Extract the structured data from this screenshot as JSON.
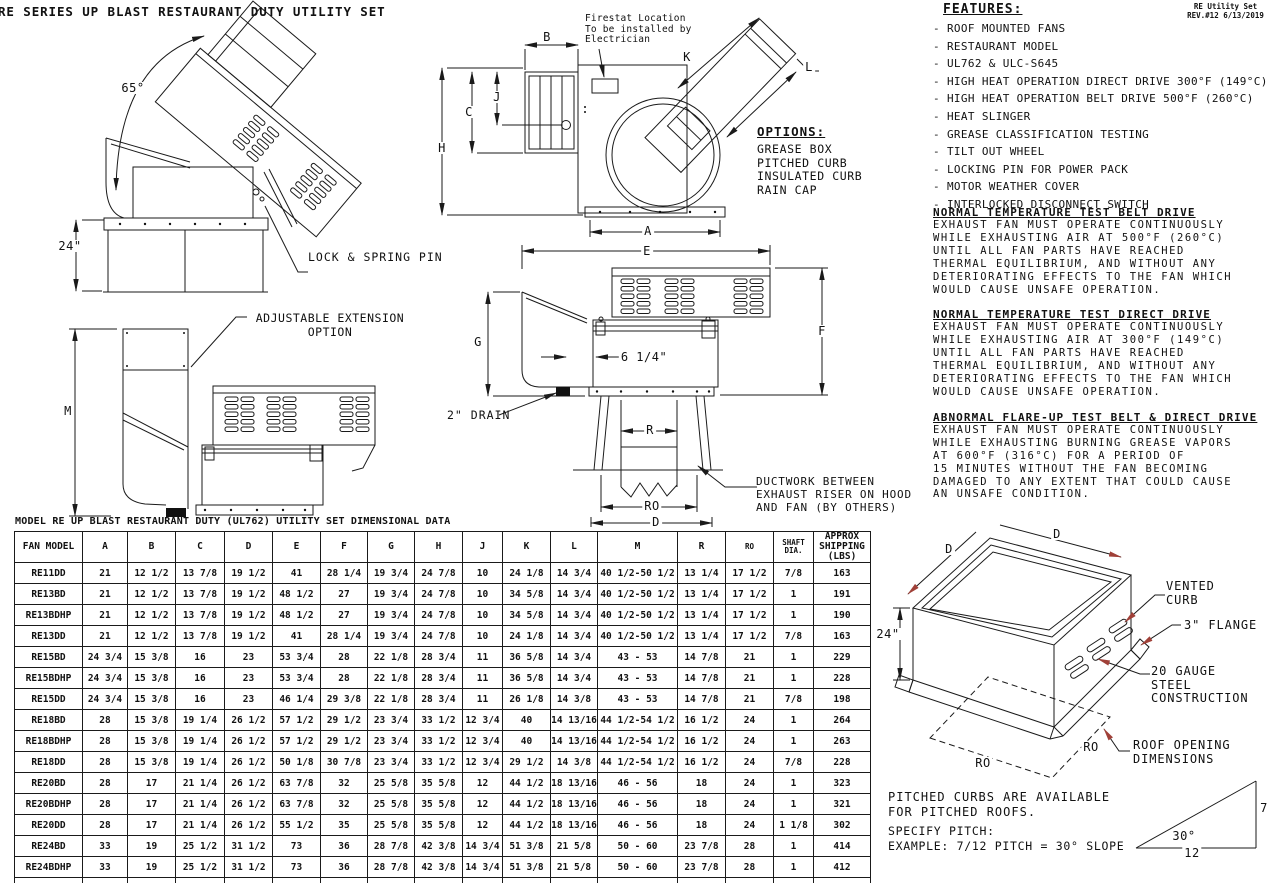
{
  "title": "RE SERIES UP BLAST RESTAURANT DUTY UTILITY SET",
  "rev_note": "RE Utility Set\nREV.#12 6/13/2019",
  "features": {
    "heading": "FEATURES:",
    "items": [
      "ROOF MOUNTED FANS",
      "RESTAURANT MODEL",
      "UL762 & ULC-S645",
      "HIGH HEAT OPERATION DIRECT DRIVE 300°F (149°C)",
      "HIGH HEAT OPERATION BELT DRIVE 500°F (260°C)",
      "HEAT SLINGER",
      "GREASE CLASSIFICATION TESTING",
      "TILT OUT WHEEL",
      "LOCKING PIN FOR POWER PACK",
      "MOTOR WEATHER COVER",
      "INTERLOCKED DISCONNECT SWITCH"
    ]
  },
  "options": {
    "heading": "OPTIONS:",
    "items": [
      "GREASE BOX",
      "PITCHED CURB",
      "INSULATED CURB",
      "RAIN CAP"
    ]
  },
  "tests": [
    {
      "heading": "NORMAL TEMPERATURE TEST BELT DRIVE",
      "body": "EXHAUST FAN MUST OPERATE CONTINUOUSLY\nWHILE EXHAUSTING AIR AT 500°F (260°C)\nUNTIL ALL FAN PARTS HAVE REACHED\nTHERMAL EQUILIBRIUM, AND WITHOUT ANY\nDETERIORATING EFFECTS TO THE FAN WHICH\nWOULD CAUSE UNSAFE OPERATION."
    },
    {
      "heading": "NORMAL TEMPERATURE TEST DIRECT DRIVE",
      "body": "EXHAUST FAN MUST OPERATE CONTINUOUSLY\nWHILE EXHAUSTING AIR AT 300°F (149°C)\nUNTIL ALL FAN PARTS HAVE REACHED\nTHERMAL EQUILIBRIUM, AND WITHOUT ANY\nDETERIORATING EFFECTS TO THE FAN WHICH\nWOULD CAUSE UNSAFE OPERATION."
    },
    {
      "heading": "ABNORMAL FLARE-UP TEST BELT & DIRECT DRIVE",
      "body": "EXHAUST FAN MUST OPERATE CONTINUOUSLY\nWHILE EXHAUSTING BURNING GREASE VAPORS\nAT 600°F (316°C) FOR A PERIOD OF\n15 MINUTES WITHOUT THE FAN BECOMING\nDAMAGED TO ANY EXTENT THAT COULD CAUSE\nAN UNSAFE CONDITION."
    }
  ],
  "notes": {
    "firestat": "Firestat Location\nTo be installed by\nElectrician",
    "lock_pin": "LOCK & SPRING PIN",
    "adjustable": "ADJUSTABLE EXTENSION\nOPTION",
    "ductwork": "DUCTWORK BETWEEN\nEXHAUST RISER ON HOOD\nAND FAN (BY OTHERS)",
    "drain": "2\" DRAIN",
    "riser_offset": "6 1/4\""
  },
  "dim_labels": {
    "a": "A",
    "b": "B",
    "c": "C",
    "d": "D",
    "e": "E",
    "f": "F",
    "g": "G",
    "h": "H",
    "j": "J",
    "k": "K",
    "l": "L",
    "m": "M",
    "r": "R",
    "ro": "RO",
    "angle": "65°",
    "h24": "24\""
  },
  "curb": {
    "d1": "D",
    "d2": "D",
    "height": "24\"",
    "ro1": "RO",
    "ro2": "RO",
    "vented": "VENTED\nCURB",
    "flange": "3\" FLANGE",
    "gauge": "20 GAUGE\nSTEEL\nCONSTRUCTION",
    "roof": "ROOF OPENING\nDIMENSIONS"
  },
  "pitch": {
    "note1": "PITCHED CURBS ARE AVAILABLE\nFOR PITCHED ROOFS.",
    "note2": "SPECIFY PITCH:\nEXAMPLE: 7/12 PITCH = 30° SLOPE",
    "angle": "30°",
    "rise": "7",
    "run": "12"
  },
  "table": {
    "title": "MODEL RE UP BLAST RESTAURANT DUTY (UL762) UTILITY SET DIMENSIONAL DATA",
    "headers": [
      "FAN MODEL",
      "A",
      "B",
      "C",
      "D",
      "E",
      "F",
      "G",
      "H",
      "J",
      "K",
      "L",
      "M",
      "R",
      "RO",
      "SHAFT\nDIA.",
      "APPROX\nSHIPPING\n(LBS)"
    ],
    "rows": [
      [
        "RE11DD",
        "21",
        "12 1/2",
        "13 7/8",
        "19 1/2",
        "41",
        "28 1/4",
        "19 3/4",
        "24 7/8",
        "10",
        "24 1/8",
        "14 3/4",
        "40 1/2-50 1/2",
        "13 1/4",
        "17 1/2",
        "7/8",
        "163"
      ],
      [
        "RE13BD",
        "21",
        "12 1/2",
        "13 7/8",
        "19 1/2",
        "48 1/2",
        "27",
        "19 3/4",
        "24 7/8",
        "10",
        "34 5/8",
        "14 3/4",
        "40 1/2-50 1/2",
        "13 1/4",
        "17 1/2",
        "1",
        "191"
      ],
      [
        "RE13BDHP",
        "21",
        "12 1/2",
        "13 7/8",
        "19 1/2",
        "48 1/2",
        "27",
        "19 3/4",
        "24 7/8",
        "10",
        "34 5/8",
        "14 3/4",
        "40 1/2-50 1/2",
        "13 1/4",
        "17 1/2",
        "1",
        "190"
      ],
      [
        "RE13DD",
        "21",
        "12 1/2",
        "13 7/8",
        "19 1/2",
        "41",
        "28 1/4",
        "19 3/4",
        "24 7/8",
        "10",
        "24 1/8",
        "14 3/4",
        "40 1/2-50 1/2",
        "13 1/4",
        "17 1/2",
        "7/8",
        "163"
      ],
      [
        "RE15BD",
        "24 3/4",
        "15 3/8",
        "16",
        "23",
        "53 3/4",
        "28",
        "22 1/8",
        "28 3/4",
        "11",
        "36 5/8",
        "14 3/4",
        "43 - 53",
        "14 7/8",
        "21",
        "1",
        "229"
      ],
      [
        "RE15BDHP",
        "24 3/4",
        "15 3/8",
        "16",
        "23",
        "53 3/4",
        "28",
        "22 1/8",
        "28 3/4",
        "11",
        "36 5/8",
        "14 3/4",
        "43 - 53",
        "14 7/8",
        "21",
        "1",
        "228"
      ],
      [
        "RE15DD",
        "24 3/4",
        "15 3/8",
        "16",
        "23",
        "46 1/4",
        "29 3/8",
        "22 1/8",
        "28 3/4",
        "11",
        "26 1/8",
        "14 3/8",
        "43 - 53",
        "14 7/8",
        "21",
        "7/8",
        "198"
      ],
      [
        "RE18BD",
        "28",
        "15 3/8",
        "19 1/4",
        "26 1/2",
        "57 1/2",
        "29 1/2",
        "23 3/4",
        "33 1/2",
        "12 3/4",
        "40",
        "14 13/16",
        "44 1/2-54 1/2",
        "16 1/2",
        "24",
        "1",
        "264"
      ],
      [
        "RE18BDHP",
        "28",
        "15 3/8",
        "19 1/4",
        "26 1/2",
        "57 1/2",
        "29 1/2",
        "23 3/4",
        "33 1/2",
        "12 3/4",
        "40",
        "14 13/16",
        "44 1/2-54 1/2",
        "16 1/2",
        "24",
        "1",
        "263"
      ],
      [
        "RE18DD",
        "28",
        "15 3/8",
        "19 1/4",
        "26 1/2",
        "50 1/8",
        "30 7/8",
        "23 3/4",
        "33 1/2",
        "12 3/4",
        "29 1/2",
        "14 3/8",
        "44 1/2-54 1/2",
        "16 1/2",
        "24",
        "7/8",
        "228"
      ],
      [
        "RE20BD",
        "28",
        "17",
        "21 1/4",
        "26 1/2",
        "63 7/8",
        "32",
        "25 5/8",
        "35 5/8",
        "12",
        "44 1/2",
        "18 13/16",
        "46 - 56",
        "18",
        "24",
        "1",
        "323"
      ],
      [
        "RE20BDHP",
        "28",
        "17",
        "21 1/4",
        "26 1/2",
        "63 7/8",
        "32",
        "25 5/8",
        "35 5/8",
        "12",
        "44 1/2",
        "18 13/16",
        "46 - 56",
        "18",
        "24",
        "1",
        "321"
      ],
      [
        "RE20DD",
        "28",
        "17",
        "21 1/4",
        "26 1/2",
        "55 1/2",
        "35",
        "25 5/8",
        "35 5/8",
        "12",
        "44 1/2",
        "18 13/16",
        "46 - 56",
        "18",
        "24",
        "1 1/8",
        "302"
      ],
      [
        "RE24BD",
        "33",
        "19",
        "25 1/2",
        "31 1/2",
        "73",
        "36",
        "28 7/8",
        "42 3/8",
        "14 3/4",
        "51 3/8",
        "21 5/8",
        "50 - 60",
        "23 7/8",
        "28",
        "1",
        "414"
      ],
      [
        "RE24BDHP",
        "33",
        "19",
        "25 1/2",
        "31 1/2",
        "73",
        "36",
        "28 7/8",
        "42 3/8",
        "14 3/4",
        "51 3/8",
        "21 5/8",
        "50 - 60",
        "23 7/8",
        "28",
        "1",
        "412"
      ],
      [
        "RE24DD",
        "33",
        "19",
        "25 1/2",
        "31 1/2",
        "64",
        "38",
        "28 7/8",
        "42 3/8",
        "14 3/4",
        "51 3/8",
        "21 5/8",
        "50 - 60",
        "23 7/8",
        "28",
        "1 3/8",
        "389"
      ]
    ]
  }
}
